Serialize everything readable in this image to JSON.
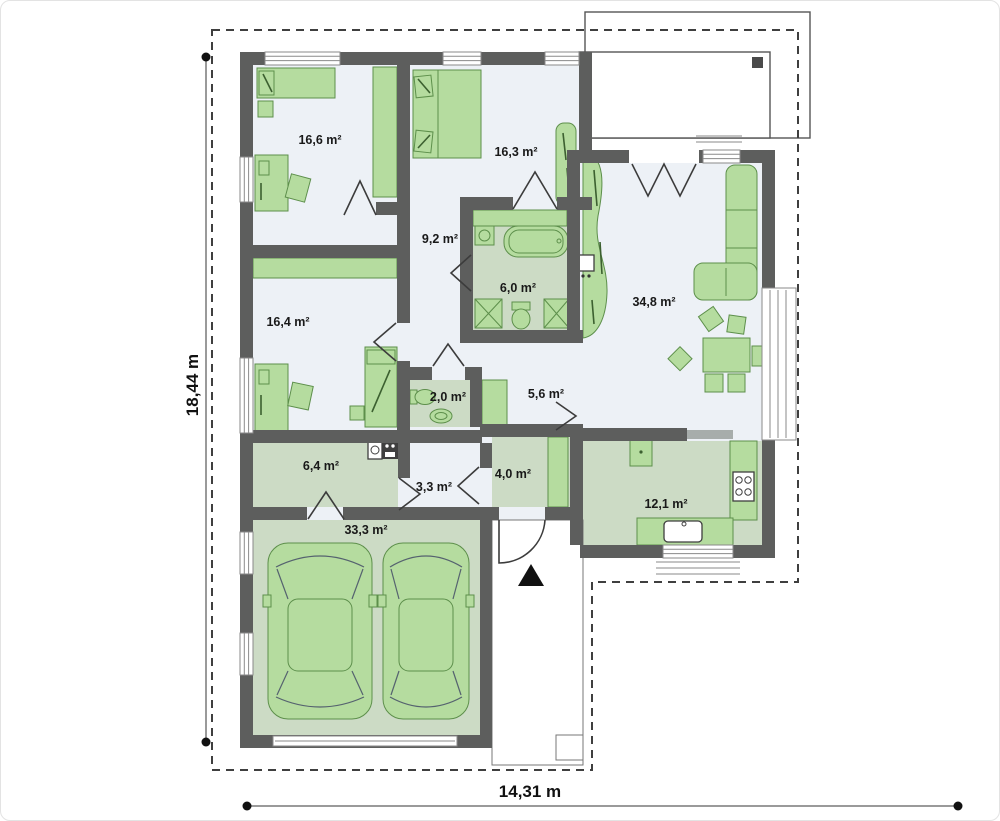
{
  "plan": {
    "title": "single-storey house floor plan",
    "dimensions": {
      "height_label": "18,44 m",
      "width_label": "14,31 m"
    },
    "rooms": [
      {
        "id": "bedroom-1",
        "label": "16,6 m²"
      },
      {
        "id": "bedroom-2",
        "label": "16,3 m²"
      },
      {
        "id": "hall",
        "label": "9,2 m²"
      },
      {
        "id": "bathroom",
        "label": "6,0 m²"
      },
      {
        "id": "living-room",
        "label": "34,8 m²"
      },
      {
        "id": "bedroom-3",
        "label": "16,4 m²"
      },
      {
        "id": "wc",
        "label": "2,0 m²"
      },
      {
        "id": "hallway",
        "label": "5,6 m²"
      },
      {
        "id": "utility",
        "label": "6,4 m²"
      },
      {
        "id": "corridor",
        "label": "3,3 m²"
      },
      {
        "id": "entry",
        "label": "4,0 m²"
      },
      {
        "id": "kitchen",
        "label": "12,1 m²"
      },
      {
        "id": "garage",
        "label": "33,3 m²"
      }
    ],
    "colors": {
      "wall": "#5d5e5d",
      "floor": "#edf1f6",
      "pale": "#ccdbc5",
      "furn": "#b5dc9f",
      "furnstroke": "#5d8f4b",
      "boundary": "#3f3f3f"
    }
  }
}
